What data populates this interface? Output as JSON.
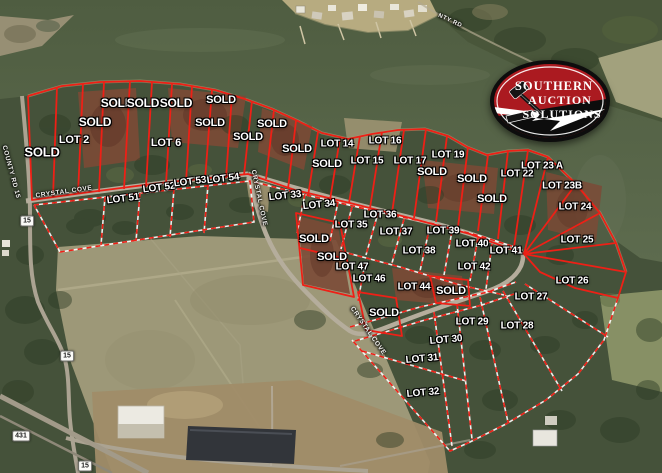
{
  "logo": {
    "lines": [
      "SOUTHERN",
      "AUCTION",
      "SOLUTIONS"
    ]
  },
  "colors": {
    "boundary_red": "#ee2016",
    "water": "#57654a",
    "forest": "#46533a",
    "field": "#9d9878",
    "logo_red": "#ab1a20",
    "logo_black": "#0d0d0d"
  },
  "route_badges": [
    {
      "text": "15",
      "x": 27,
      "y": 221
    },
    {
      "text": "15",
      "x": 67,
      "y": 356
    },
    {
      "text": "431",
      "x": 21,
      "y": 436
    },
    {
      "text": "15",
      "x": 85,
      "y": 466
    }
  ],
  "road_labels": [
    {
      "text": "COUNTY RD 15",
      "x": 11,
      "y": 172,
      "rot": 75,
      "size": 6.5
    },
    {
      "text": "CRYSTAL COVE",
      "x": 64,
      "y": 192,
      "rot": -8,
      "size": 6.5
    },
    {
      "text": "CRYSTAL COVE",
      "x": 259,
      "y": 198,
      "rot": 78,
      "size": 6.5
    },
    {
      "text": "CRYSTAL COVE",
      "x": 368,
      "y": 331,
      "rot": 55,
      "size": 6.5
    },
    {
      "text": "NTY RD",
      "x": 450,
      "y": 21,
      "rot": 25,
      "size": 6
    }
  ],
  "lot_labels": [
    {
      "text": "SOLD",
      "x": 42,
      "y": 152,
      "size": 13
    },
    {
      "text": "LOT 2",
      "x": 74,
      "y": 140,
      "size": 11
    },
    {
      "text": "SOLD",
      "x": 95,
      "y": 122,
      "size": 12
    },
    {
      "text": "SOLD",
      "x": 117,
      "y": 103,
      "size": 12
    },
    {
      "text": "SOLD",
      "x": 143,
      "y": 103,
      "size": 12
    },
    {
      "text": "SOLD",
      "x": 176,
      "y": 103,
      "size": 12
    },
    {
      "text": "LOT 6",
      "x": 166,
      "y": 143,
      "size": 11
    },
    {
      "text": "SOLD",
      "x": 221,
      "y": 100,
      "size": 11
    },
    {
      "text": "SOLD",
      "x": 210,
      "y": 123,
      "size": 11
    },
    {
      "text": "SOLD",
      "x": 248,
      "y": 137,
      "size": 11
    },
    {
      "text": "SOLD",
      "x": 272,
      "y": 124,
      "size": 11
    },
    {
      "text": "SOLD",
      "x": 297,
      "y": 149,
      "size": 11
    },
    {
      "text": "SOLD",
      "x": 327,
      "y": 164,
      "size": 11
    },
    {
      "text": "LOT 14",
      "x": 337,
      "y": 144,
      "size": 10
    },
    {
      "text": "LOT 15",
      "x": 367,
      "y": 161,
      "size": 10
    },
    {
      "text": "LOT 16",
      "x": 385,
      "y": 141,
      "size": 10
    },
    {
      "text": "LOT 17",
      "x": 410,
      "y": 161,
      "size": 10
    },
    {
      "text": "LOT 19",
      "x": 448,
      "y": 155,
      "size": 10
    },
    {
      "text": "SOLD",
      "x": 432,
      "y": 172,
      "size": 11
    },
    {
      "text": "SOLD",
      "x": 472,
      "y": 179,
      "size": 11
    },
    {
      "text": "LOT 22",
      "x": 517,
      "y": 174,
      "size": 10
    },
    {
      "text": "SOLD",
      "x": 492,
      "y": 199,
      "size": 11
    },
    {
      "text": "LOT 23 A",
      "x": 542,
      "y": 166,
      "size": 10
    },
    {
      "text": "LOT 23B",
      "x": 562,
      "y": 186,
      "size": 10
    },
    {
      "text": "LOT 24",
      "x": 575,
      "y": 207,
      "size": 10
    },
    {
      "text": "LOT 25",
      "x": 577,
      "y": 240,
      "size": 10
    },
    {
      "text": "LOT 51",
      "x": 123,
      "y": 199,
      "size": 10,
      "rot": -7
    },
    {
      "text": "LOT 52",
      "x": 159,
      "y": 188,
      "size": 10,
      "rot": -7
    },
    {
      "text": "LOT 53",
      "x": 190,
      "y": 182,
      "size": 10,
      "rot": -7
    },
    {
      "text": "LOT 54",
      "x": 223,
      "y": 179,
      "size": 10,
      "rot": -7
    },
    {
      "text": "LOT 33",
      "x": 285,
      "y": 196,
      "size": 10,
      "rot": -6
    },
    {
      "text": "LOT 34",
      "x": 319,
      "y": 205,
      "size": 10,
      "rot": -6
    },
    {
      "text": "LOT 35",
      "x": 351,
      "y": 225,
      "size": 10
    },
    {
      "text": "LOT 36",
      "x": 380,
      "y": 215,
      "size": 10
    },
    {
      "text": "LOT 37",
      "x": 396,
      "y": 232,
      "size": 10
    },
    {
      "text": "LOT 38",
      "x": 419,
      "y": 251,
      "size": 10
    },
    {
      "text": "LOT 39",
      "x": 443,
      "y": 231,
      "size": 10
    },
    {
      "text": "LOT 40",
      "x": 472,
      "y": 244,
      "size": 10
    },
    {
      "text": "LOT 41",
      "x": 506,
      "y": 251,
      "size": 10
    },
    {
      "text": "LOT 42",
      "x": 474,
      "y": 267,
      "size": 10
    },
    {
      "text": "SOLD",
      "x": 314,
      "y": 239,
      "size": 11
    },
    {
      "text": "SOLD",
      "x": 332,
      "y": 257,
      "size": 11
    },
    {
      "text": "LOT 47",
      "x": 352,
      "y": 267,
      "size": 10
    },
    {
      "text": "LOT 46",
      "x": 369,
      "y": 279,
      "size": 10
    },
    {
      "text": "LOT 44",
      "x": 414,
      "y": 287,
      "size": 10
    },
    {
      "text": "SOLD",
      "x": 451,
      "y": 291,
      "size": 11
    },
    {
      "text": "SOLD",
      "x": 384,
      "y": 313,
      "size": 11
    },
    {
      "text": "LOT 26",
      "x": 572,
      "y": 281,
      "size": 10
    },
    {
      "text": "LOT 27",
      "x": 531,
      "y": 297,
      "size": 10
    },
    {
      "text": "LOT 28",
      "x": 517,
      "y": 326,
      "size": 10
    },
    {
      "text": "LOT 29",
      "x": 472,
      "y": 322,
      "size": 10
    },
    {
      "text": "LOT 30",
      "x": 446,
      "y": 340,
      "size": 10,
      "rot": -5
    },
    {
      "text": "LOT 31",
      "x": 422,
      "y": 359,
      "size": 10,
      "rot": -5
    },
    {
      "text": "LOT 32",
      "x": 423,
      "y": 393,
      "size": 10,
      "rot": -5
    }
  ]
}
